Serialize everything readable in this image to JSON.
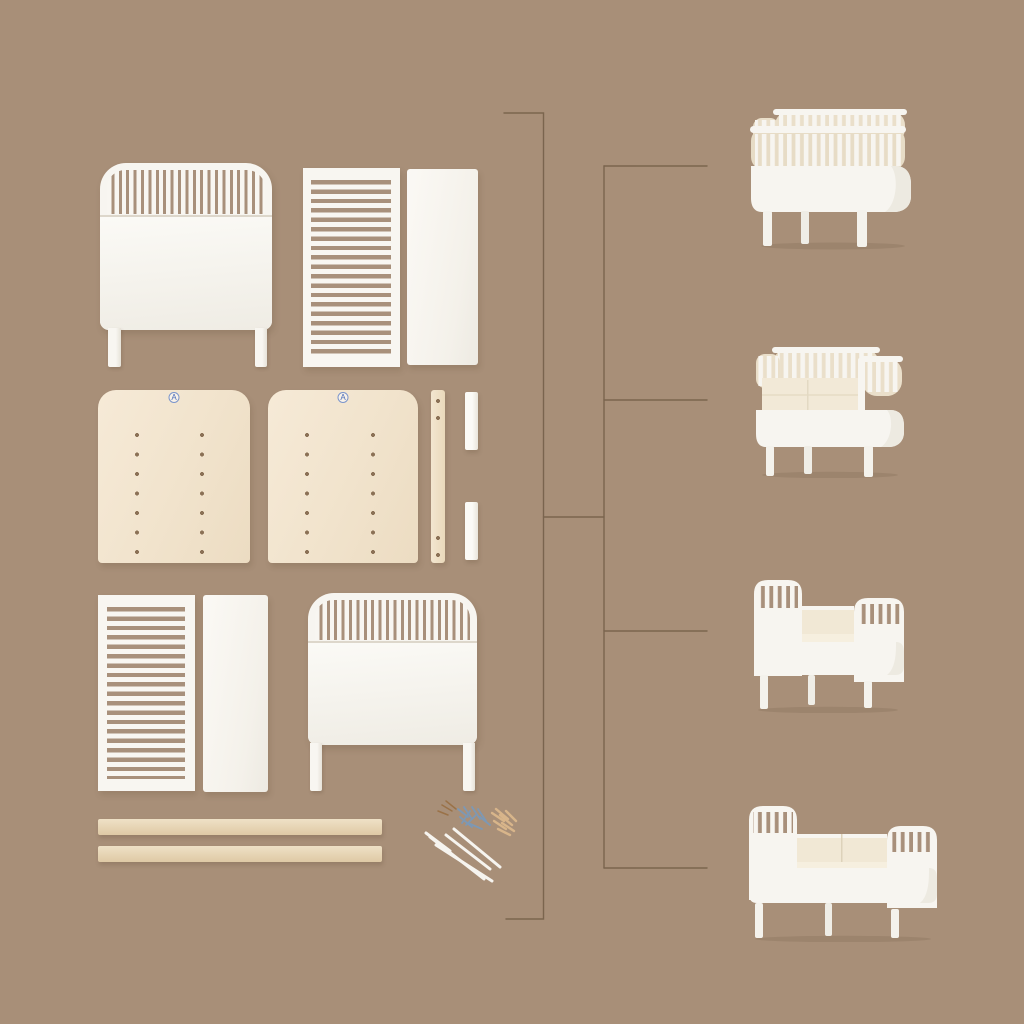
{
  "scene": {
    "type": "crib-assembly-parts-diagram",
    "background_color": "#a88f78",
    "connector_line_color": "#6f5a44",
    "part_white_color": "#f8f6f1",
    "plywood_color": "#f3e6d1",
    "hardware_screw_color": "#7d98b4",
    "hardware_dowel_color": "#d8b58a"
  },
  "labels": {
    "plywood_sticker": "A"
  },
  "parts": [
    {
      "name": "crib-endboard-with-legs-top"
    },
    {
      "name": "slatted-side-panel-top"
    },
    {
      "name": "solid-side-panel-top"
    },
    {
      "name": "mattress-base-board-left",
      "sticker": "A"
    },
    {
      "name": "mattress-base-board-right",
      "sticker": "A"
    },
    {
      "name": "drilled-support-strip"
    },
    {
      "name": "spacer-block-top"
    },
    {
      "name": "spacer-block-bottom"
    },
    {
      "name": "slatted-side-panel-bottom"
    },
    {
      "name": "solid-side-panel-bottom"
    },
    {
      "name": "crib-endboard-with-legs-bottom"
    },
    {
      "name": "wooden-extension-rail-1"
    },
    {
      "name": "wooden-extension-rail-2"
    },
    {
      "name": "hardware-kit-screws-dowels-rods"
    }
  ],
  "stages": [
    {
      "name": "baby-crib-all-slats"
    },
    {
      "name": "crib-front-slats-removed"
    },
    {
      "name": "junior-bed-open-front"
    },
    {
      "name": "junior-bed-extended"
    }
  ]
}
